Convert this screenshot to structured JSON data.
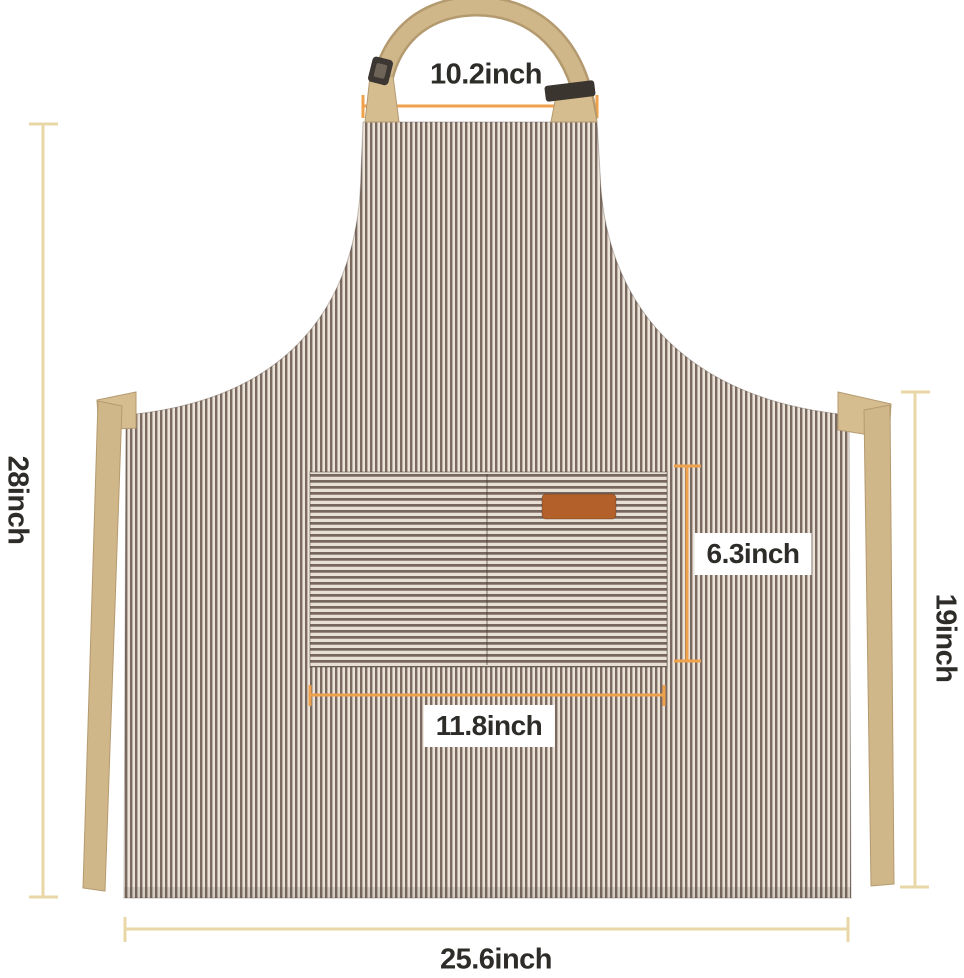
{
  "diagram": {
    "subject": "striped bib apron with center pocket, neck strap and waist ties",
    "measurements": {
      "neck_strap_width": "10.2inch",
      "total_height": "28inch",
      "waist_height": "19inch",
      "pocket_height": "6.3inch",
      "pocket_width": "11.8inch",
      "bottom_width": "25.6inch"
    },
    "colors": {
      "background": "#ffffff",
      "stripe_dark": "#7a6a60",
      "stripe_light": "#ebe3d8",
      "pocket_stripe_dark": "#76665d",
      "pocket_stripe_light": "#e8e0d5",
      "strap_khaki": "#d0b78a",
      "strap_edge": "#b49a6f",
      "buckle_dark": "#3c3733",
      "leather_patch": "#b3602a",
      "measure_line_tan": "#ead7a7",
      "measure_line_orange": "#f0a14b",
      "label_text": "#2e2c29"
    }
  }
}
